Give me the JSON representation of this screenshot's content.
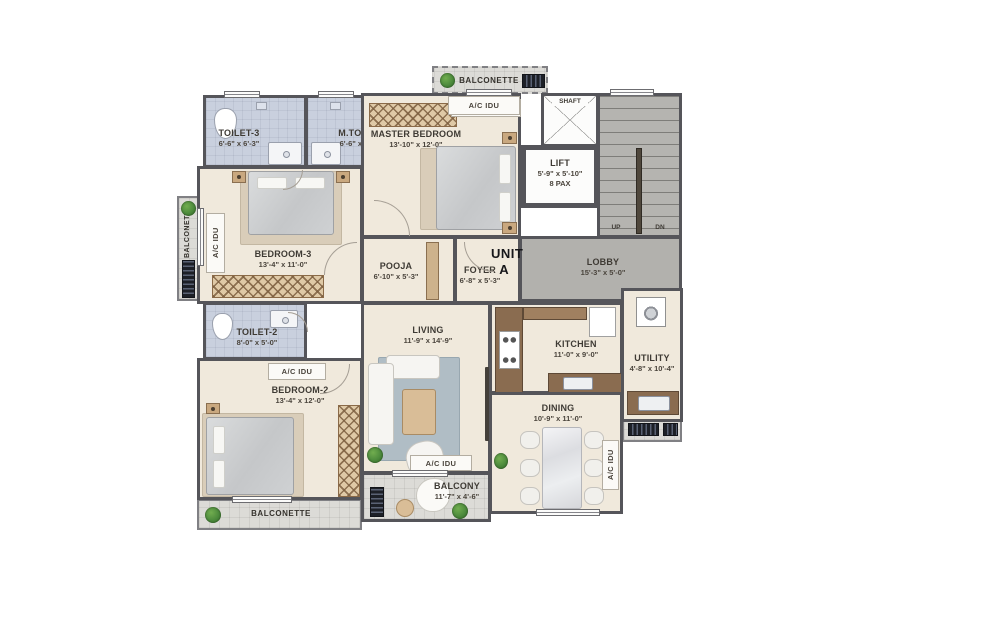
{
  "plan": {
    "unit": {
      "line1": "UNIT",
      "line2": "A"
    },
    "rooms": {
      "toilet3": {
        "name": "TOILET-3",
        "dims": "6'-6\" x 6'-3\""
      },
      "mtoilet": {
        "name": "M.TOILET",
        "dims": "6'-6\" x 6'-3\""
      },
      "master": {
        "name": "MASTER BEDROOM",
        "dims": "13'-10\" x 12'-0\""
      },
      "lift": {
        "name": "LIFT",
        "dims": "5'-9\" x 5'-10\"",
        "pax": "8 PAX"
      },
      "lobby": {
        "name": "LOBBY",
        "dims": "15'-3\" x 5'-0\""
      },
      "bedroom3": {
        "name": "BEDROOM-3",
        "dims": "13'-4\" x 11'-0\""
      },
      "pooja": {
        "name": "POOJA",
        "dims": "6'-10\" x 5'-3\""
      },
      "foyer": {
        "name": "FOYER",
        "dims": "6'-8\" x 5'-3\""
      },
      "toilet2": {
        "name": "TOILET-2",
        "dims": "8'-0\" x 5'-0\""
      },
      "bedroom2": {
        "name": "BEDROOM-2",
        "dims": "13'-4\" x 12'-0\""
      },
      "living": {
        "name": "LIVING",
        "dims": "11'-9\" x 14'-9\""
      },
      "kitchen": {
        "name": "KITCHEN",
        "dims": "11'-0\" x 9'-0\""
      },
      "utility": {
        "name": "UTILITY",
        "dims": "4'-8\" x 10'-4\""
      },
      "dining": {
        "name": "DINING",
        "dims": "10'-9\" x 11'-0\""
      },
      "balcony": {
        "name": "BALCONY",
        "dims": "11'-7\" x 4'-6\""
      }
    },
    "common": {
      "balconette": "BALCONETTE",
      "ac_idu": "A/C IDU",
      "shaft": "SHAFT",
      "up": "UP",
      "dn": "DN"
    },
    "colors": {
      "wall": "#55555a",
      "floor_unit": "#f0e9dc",
      "floor_toilet": "#c9d0de",
      "floor_common": "#b2b1ad",
      "floor_balcony": "#dcdbd7",
      "wood": "#c9a87f",
      "counter": "#8a6c50",
      "rug": "#b0bdc5",
      "plant": "#4c8a3c",
      "text": "#3e3a34"
    }
  }
}
